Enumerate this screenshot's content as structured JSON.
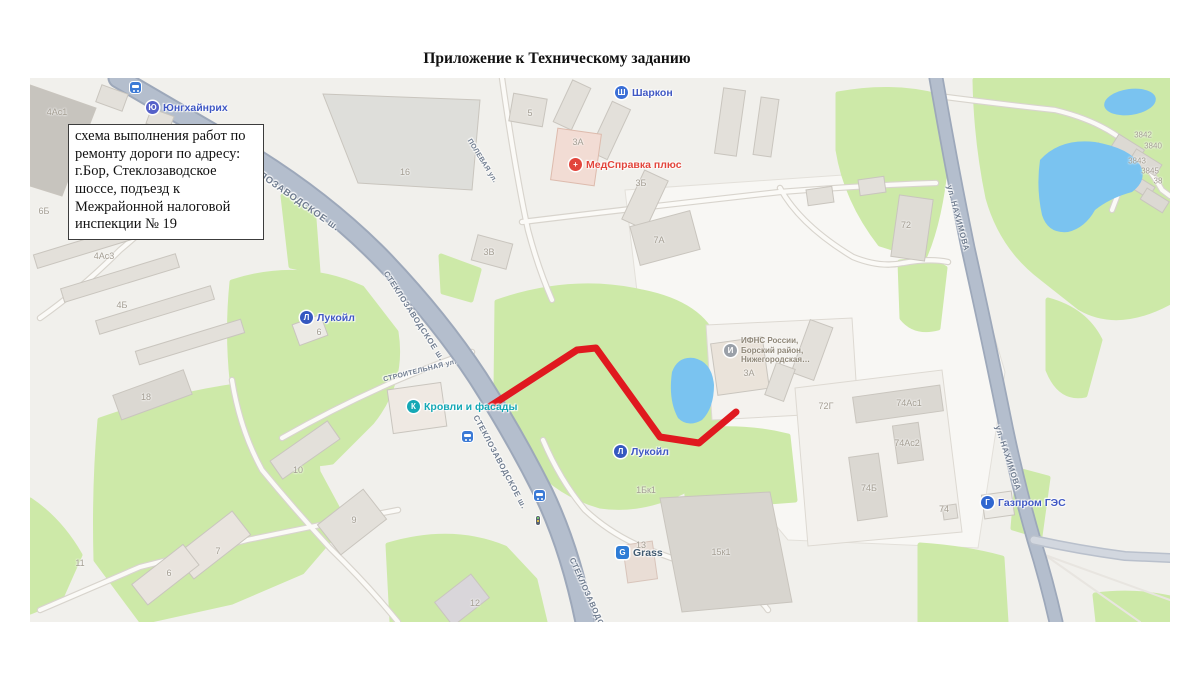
{
  "page": {
    "title": "Приложение к Техническому заданию"
  },
  "note": {
    "text": "схема выполнения работ по ремонту дороги по адресу: г.Бор, Стеклозаводское шоссе, подъезд к Межрайонной налоговой инспекции № 19"
  },
  "map": {
    "streets": [
      "СТЕКЛОЗАВОДСКОЕ ш.",
      "СТЕКЛОЗАВОДСКОЕ ш.",
      "СТЕКЛОЗАВОДСКОЕ ш.",
      "СТЕКЛОЗАВОДСКОЕ ш.",
      "СТРОИТЕЛЬНАЯ ул.",
      "ПОЛЕВАЯ ул.",
      "ул. НАХИМОВА",
      "ул. НАХИМОВА"
    ],
    "poi": [
      {
        "label": "Юнгхайнрих",
        "icon": "Ю"
      },
      {
        "label": "Шаркон",
        "icon": "Ш"
      },
      {
        "label": "МедСправка плюс",
        "icon": "+"
      },
      {
        "label": "Лукойл",
        "icon": "Л"
      },
      {
        "label": "Кровли и фасады",
        "icon": "К"
      },
      {
        "label": "Лукойл",
        "icon": "Л"
      },
      {
        "label": "Grass",
        "icon": "G"
      },
      {
        "label": "Газпром ГЭС",
        "icon": "Г"
      },
      {
        "label": "ИФНС России,",
        "label2": "Борский район,",
        "label3": "Нижегородская…",
        "icon": "И"
      }
    ],
    "buildings": [
      "4Ас1",
      "6Б",
      "4Ас3",
      "4Б",
      "18",
      "10",
      "11",
      "7",
      "6",
      "9",
      "16",
      "5",
      "3А",
      "3Б",
      "3В",
      "7А",
      "72",
      "72Г",
      "74Ас1",
      "74Ас2",
      "74Б",
      "74",
      "1Бк1",
      "13",
      "15к1",
      "12",
      "6",
      "3А",
      "3842",
      "3840",
      "3843",
      "3845",
      "38"
    ],
    "colors": {
      "route": "#e0191f",
      "water": "#7ac3f0",
      "green": "#cde9a8",
      "road": "#b4becd"
    }
  }
}
